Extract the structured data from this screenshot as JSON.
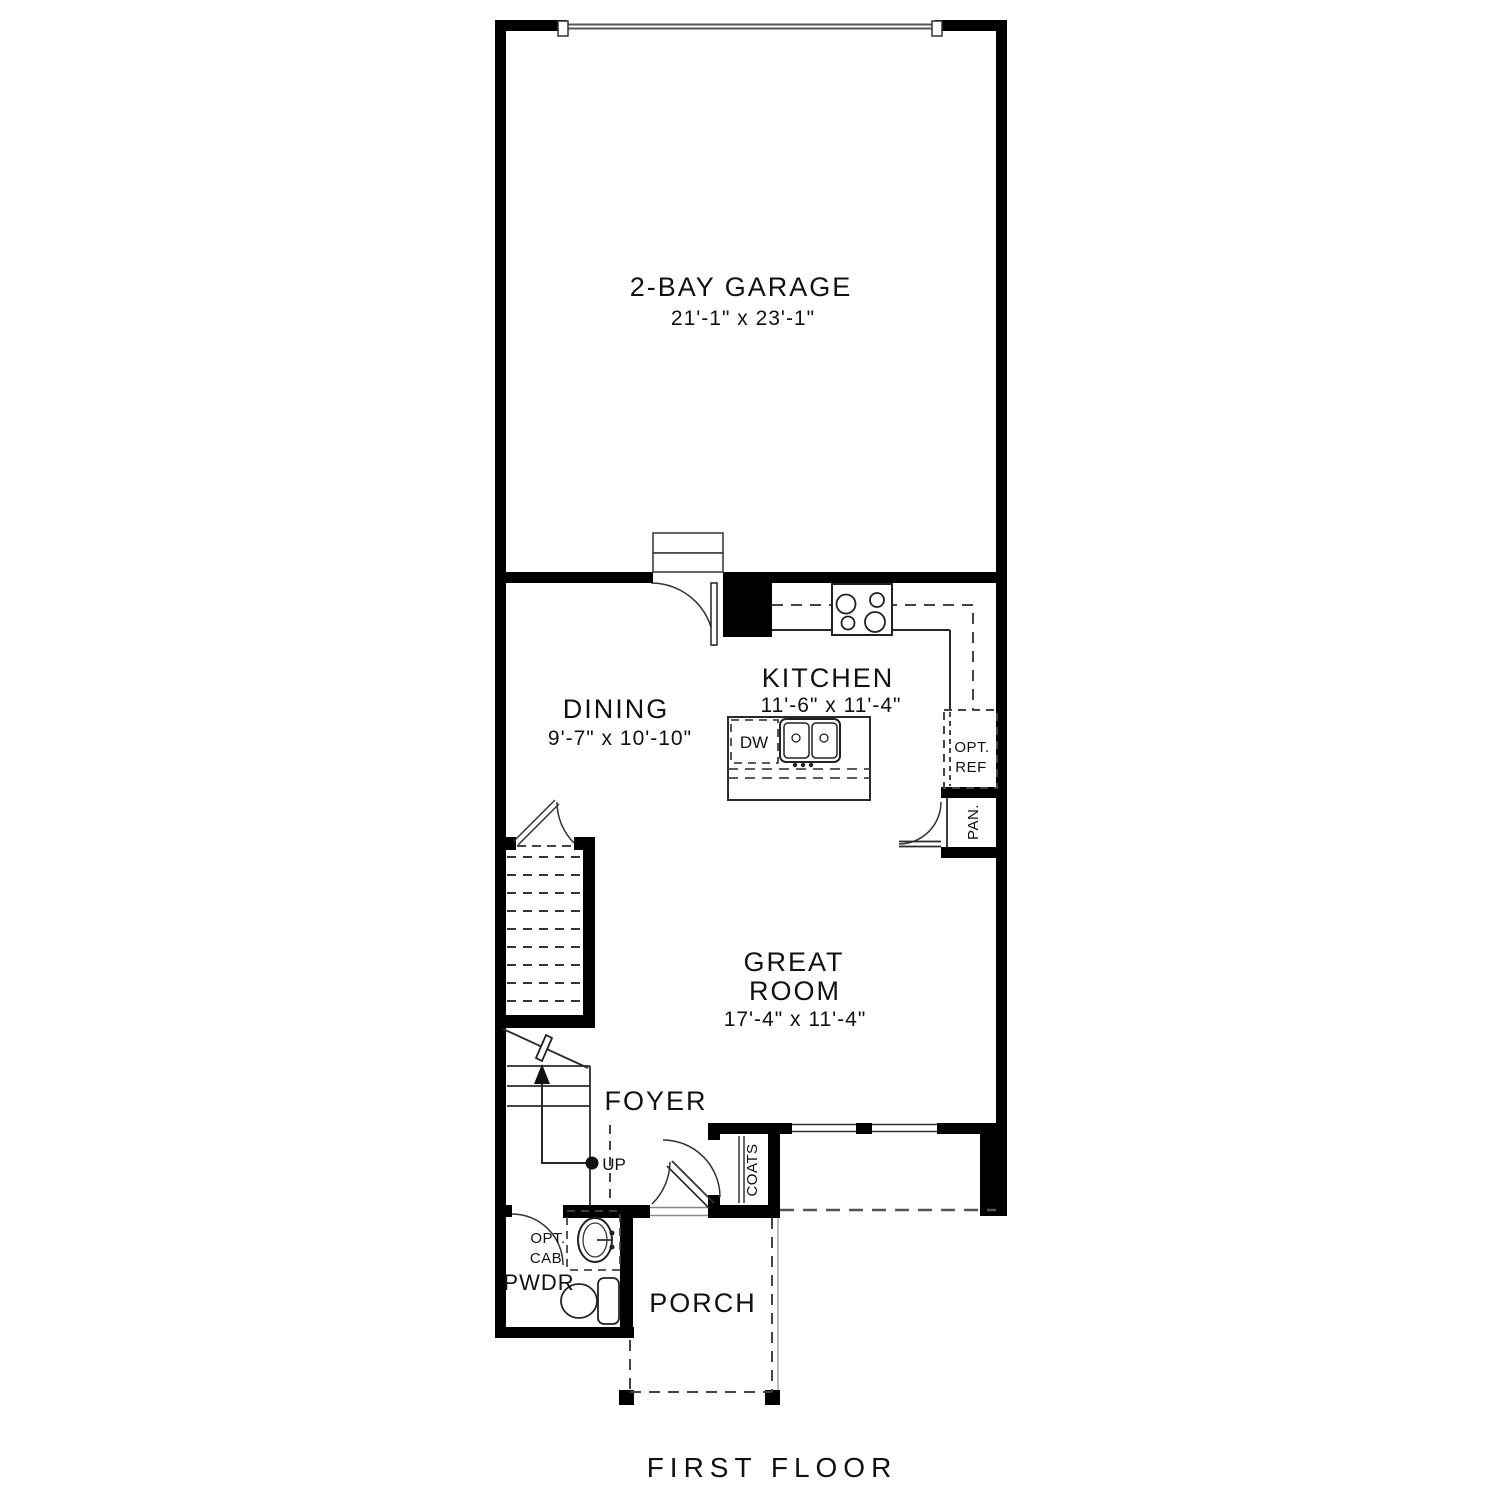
{
  "plan_title": "FIRST FLOOR",
  "rooms": {
    "garage": {
      "label": "2-BAY GARAGE",
      "dims": "21'-1\" x 23'-1\""
    },
    "dining": {
      "label": "DINING",
      "dims": "9'-7\" x 10'-10\""
    },
    "kitchen": {
      "label": "KITCHEN",
      "dims": "11'-6\" x 11'-4\""
    },
    "great_room": {
      "label_line1": "GREAT",
      "label_line2": "ROOM",
      "dims": "17'-4\" x 11'-4\""
    },
    "foyer": {
      "label": "FOYER"
    },
    "powder": {
      "label": "PWDR"
    },
    "porch": {
      "label": "PORCH"
    }
  },
  "fixtures": {
    "dishwasher": "DW",
    "opt_ref_line1": "OPT.",
    "opt_ref_line2": "REF",
    "pantry": "PAN.",
    "coats": "COATS",
    "up": "UP",
    "opt_cab_line1": "OPT.",
    "opt_cab_line2": "CAB"
  },
  "colors": {
    "wall": "#000000",
    "line": "#333333",
    "dashed": "#444444",
    "background": "#ffffff"
  }
}
